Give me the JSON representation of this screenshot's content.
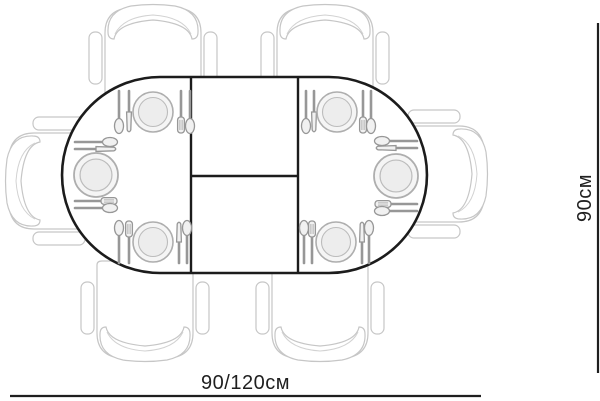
{
  "labels": {
    "width": "90/120см",
    "depth": "90см"
  },
  "table": {
    "shape": "oval-extendable",
    "seat_count": 6,
    "place_setting_count": 6
  },
  "colors": {
    "outline": "#1c1c1c",
    "sketch_gray": "#c6c6c6",
    "cutlery_gray": "#979797",
    "plate_fill": "#f5f5f5",
    "dimension_text": "#1f1f1f",
    "background": "#ffffff"
  }
}
